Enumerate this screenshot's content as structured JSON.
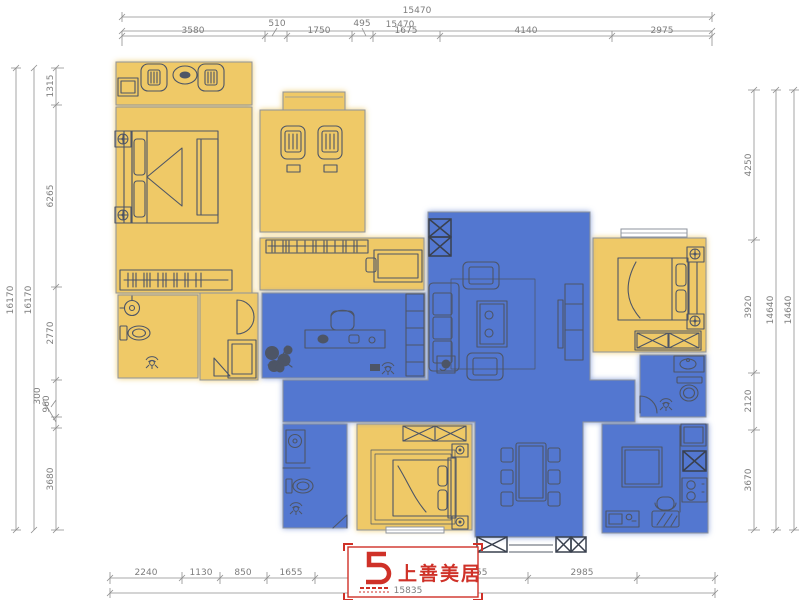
{
  "colors": {
    "room_yellow": "#efc967",
    "room_blue": "#5377d0",
    "furniture_line": "#4d5566",
    "wall_line": "#8e939c",
    "dimension_line": "#8f8f8f",
    "dimension_text": "#7d7d7d",
    "logo_red": "#cf3128"
  },
  "dimensions": {
    "top": {
      "total_outer": "15470",
      "total_inner": "15470",
      "segments": [
        "3580",
        "510",
        "1750",
        "495",
        "1675",
        "4140",
        "2975"
      ]
    },
    "left": {
      "total_outer": "16170",
      "total_inner": "16170",
      "segments": [
        "1315",
        "6265",
        "2770",
        "300",
        "960",
        "3680"
      ]
    },
    "right": {
      "segments": [
        "4250",
        "3920",
        "2120",
        "3670"
      ],
      "total_inner": "14640",
      "total_outer": "14640"
    },
    "bottom": {
      "segments": [
        "2240",
        "1130",
        "850",
        "1655",
        "2855",
        "2985"
      ],
      "total": "15835"
    }
  },
  "logo": {
    "text": "上善美居"
  }
}
